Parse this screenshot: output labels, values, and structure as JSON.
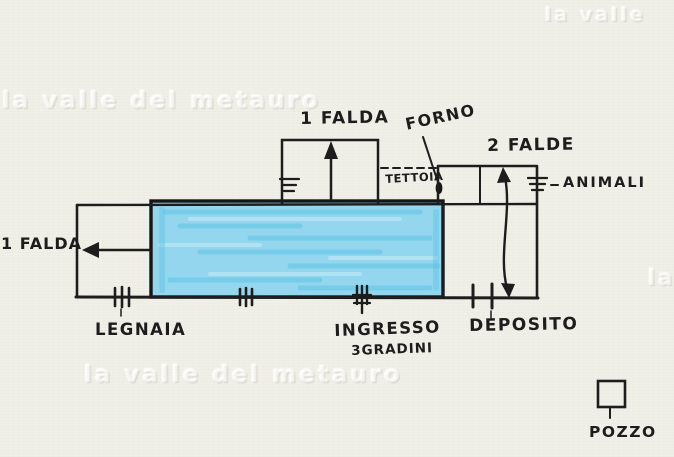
{
  "diagram": {
    "type": "hand-drawn-building-plan",
    "labels": {
      "roof_top": "1 FALDA",
      "forno": "FORNO",
      "roof_right": "2 FALDE",
      "tettoia": "TETTOIA",
      "animali": "ANIMALI",
      "roof_left": "1 FALDA",
      "legnaia": "LEGNAIA",
      "ingresso": "INGRESSO",
      "ingresso_steps": "3GRADINI",
      "deposito": "DEPOSITO",
      "pozzo": "POZZO"
    },
    "colors": {
      "paper": "#f0efe7",
      "ink": "#1d1d1d",
      "room_fill": "#93d6ee",
      "room_streak_dark": "#54c2e2",
      "room_streak_light": "#c9ecf7"
    }
  },
  "watermark": {
    "full": "la valle del metauro",
    "partial_top_right": "la valle",
    "partial_right_edge": "la"
  }
}
